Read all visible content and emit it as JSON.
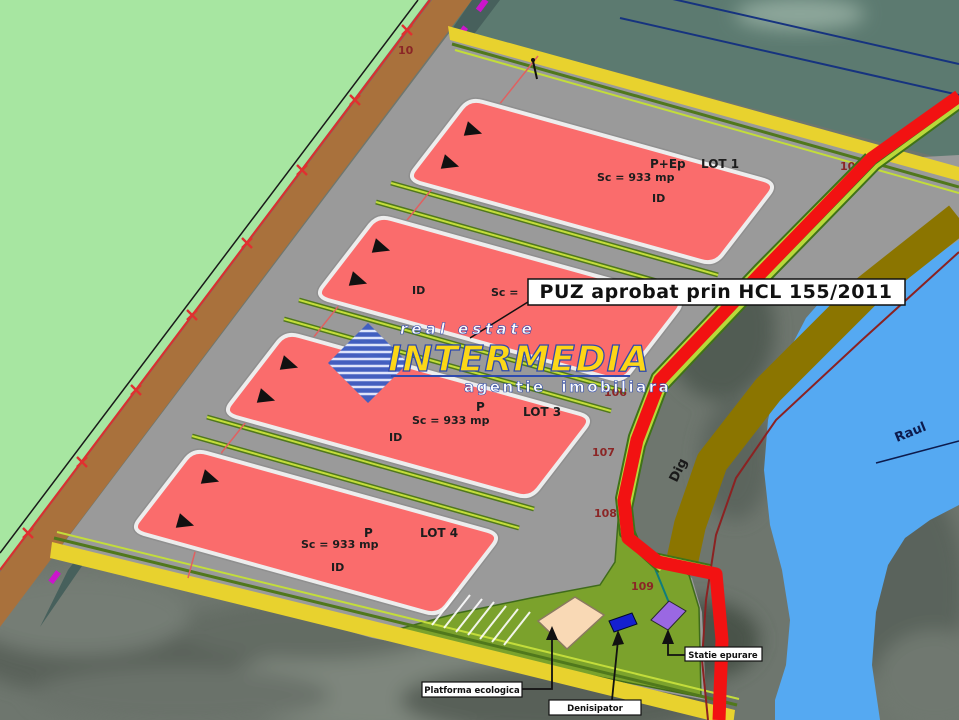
{
  "title_box": {
    "text": "PUZ aprobat prin HCL 155/2011"
  },
  "watermark": {
    "top": "real estate",
    "brand": "INTERMEDIA",
    "bottom": "agentie imobiliara"
  },
  "lots": {
    "lot1": {
      "regime": "P+Ep",
      "name": "LOT 1",
      "area": "Sc = 933 mp",
      "id": "ID"
    },
    "lot2": {
      "area_partial": "Sc =",
      "id": "ID"
    },
    "lot3": {
      "regime": "P",
      "name": "LOT 3",
      "area": "Sc = 933 mp",
      "id": "ID"
    },
    "lot4": {
      "regime": "P",
      "name": "LOT 4",
      "area": "Sc = 933 mp",
      "id": "ID"
    }
  },
  "features": {
    "dike": "Dig",
    "river": "Raul"
  },
  "callouts": {
    "platform": "Platforma ecologica",
    "sand_trap": "Denisipator",
    "treatment": "Statie epurare"
  },
  "survey_points": {
    "p10": "10",
    "p105": "105",
    "p106": "106",
    "p107": "107",
    "p108": "108",
    "p109": "109"
  },
  "colors": {
    "boundary_red": "#f21212",
    "lot_fill": "#fa6c6c",
    "river_blue": "#55a9f2",
    "field_green": "#a7e6a1",
    "band_yellow": "#e8d22e",
    "dike_olive": "#8b7500",
    "magenta_marks": "#cb15cb",
    "watermark_yellow": "#ffd914",
    "watermark_blue": "#2b48b0"
  }
}
